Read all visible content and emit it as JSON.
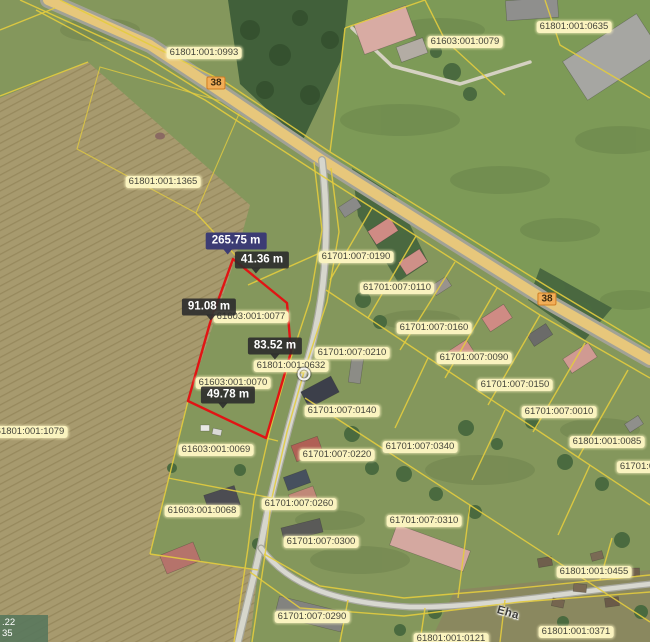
{
  "map": {
    "parcel_labels": [
      {
        "text": "61801:001:0993",
        "x": 204,
        "y": 53
      },
      {
        "text": "61603:001:0079",
        "x": 465,
        "y": 42
      },
      {
        "text": "61801:001:0635",
        "x": 574,
        "y": 27
      },
      {
        "text": "61801:001:1365",
        "x": 163,
        "y": 182
      },
      {
        "text": "61701:007:0190",
        "x": 356,
        "y": 257
      },
      {
        "text": "61701:007:0110",
        "x": 397,
        "y": 288
      },
      {
        "text": "61603:001:0077",
        "x": 251,
        "y": 317
      },
      {
        "text": "61701:007:0160",
        "x": 434,
        "y": 328
      },
      {
        "text": "61701:007:0210",
        "x": 352,
        "y": 353
      },
      {
        "text": "61701:007:0090",
        "x": 474,
        "y": 358
      },
      {
        "text": "61801:001:0632",
        "x": 291,
        "y": 366
      },
      {
        "text": "61603:001:0070",
        "x": 233,
        "y": 383
      },
      {
        "text": "61701:007:0150",
        "x": 515,
        "y": 385
      },
      {
        "text": "61701:007:0140",
        "x": 342,
        "y": 411
      },
      {
        "text": "61701:007:0010",
        "x": 559,
        "y": 412
      },
      {
        "text": "61801:001:1079",
        "x": 30,
        "y": 432
      },
      {
        "text": "61801:001:0085",
        "x": 607,
        "y": 442
      },
      {
        "text": "61701:007:0340",
        "x": 420,
        "y": 447
      },
      {
        "text": "61603:001:0069",
        "x": 216,
        "y": 450
      },
      {
        "text": "61701:007:0220",
        "x": 337,
        "y": 455
      },
      {
        "text": "61701:0",
        "x": 637,
        "y": 467
      },
      {
        "text": "61701:007:0260",
        "x": 299,
        "y": 504
      },
      {
        "text": "61603:001:0068",
        "x": 202,
        "y": 511
      },
      {
        "text": "61701:007:0310",
        "x": 424,
        "y": 521
      },
      {
        "text": "61701:007:0300",
        "x": 321,
        "y": 542
      },
      {
        "text": "61801:001:0455",
        "x": 594,
        "y": 572
      },
      {
        "text": "61701:007:0290",
        "x": 312,
        "y": 617
      },
      {
        "text": "61801:001:0371",
        "x": 576,
        "y": 632
      },
      {
        "text": "61801:001:0121",
        "x": 451,
        "y": 639
      }
    ],
    "measurement_labels": [
      {
        "text": "265.75 m",
        "x": 236,
        "y": 241,
        "selected": true,
        "ptr": -8
      },
      {
        "text": "41.36 m",
        "x": 262,
        "y": 260,
        "selected": false,
        "ptr": -6
      },
      {
        "text": "91.08 m",
        "x": 209,
        "y": 307,
        "selected": false,
        "ptr": 2
      },
      {
        "text": "83.52 m",
        "x": 275,
        "y": 346,
        "selected": false,
        "ptr": 0
      },
      {
        "text": "49.78 m",
        "x": 228,
        "y": 395,
        "selected": false,
        "ptr": -5
      }
    ],
    "road_badges": [
      {
        "text": "38",
        "x": 216,
        "y": 83
      },
      {
        "text": "38",
        "x": 547,
        "y": 299
      }
    ],
    "street_labels": [
      {
        "text": "Eha",
        "x": 508,
        "y": 613,
        "rotation": 16
      }
    ],
    "selection_marker": {
      "x": 304,
      "y": 374
    },
    "coordinate_readout": {
      "line1": ".22",
      "line2": "35"
    },
    "colors": {
      "boundary_yellow": "#e3cc3e",
      "selection_red": "#e11414",
      "label_bg": "#faf3bf",
      "label_text": "#45453b",
      "measure_selected_bg": "#3c3c74",
      "road_badge_bg": "#f2ae58",
      "road_badge_border": "#cf7d22"
    }
  }
}
